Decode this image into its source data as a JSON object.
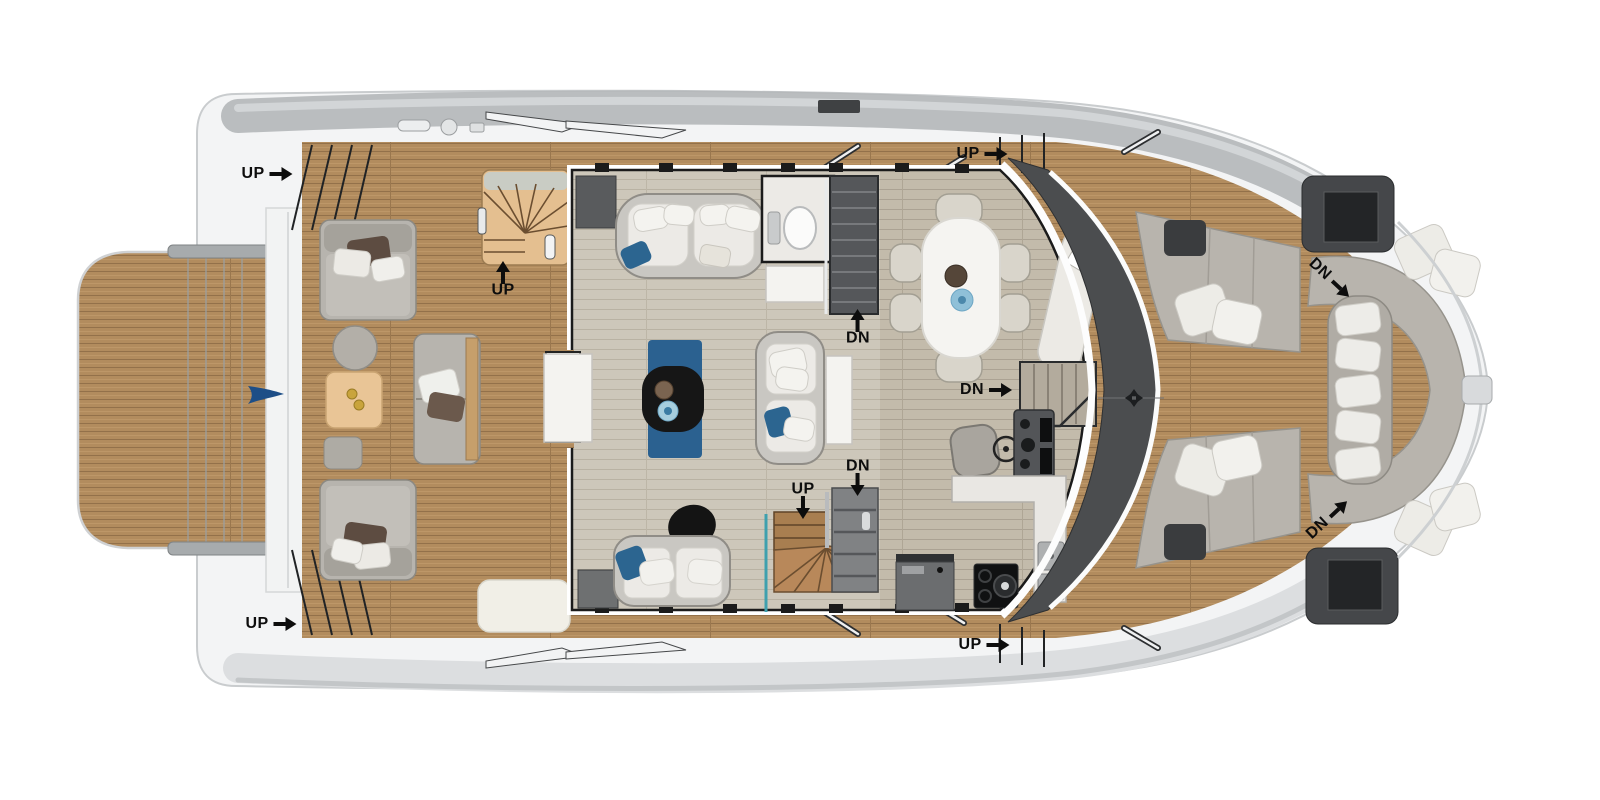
{
  "diagram": {
    "type": "yacht-deck-floor-plan",
    "subject": "power-catamaran main deck, top view, bow to the right",
    "deck_labels": [
      {
        "id": "aft-port-side-steps",
        "text": "UP",
        "arrow": "right"
      },
      {
        "id": "cockpit-flybridge-stairs",
        "text": "UP",
        "arrow": "up"
      },
      {
        "id": "port-side-deck-steps",
        "text": "UP",
        "arrow": "right"
      },
      {
        "id": "port-hull-stairs",
        "text": "DN",
        "arrow": "up"
      },
      {
        "id": "starboard-hull-stairs",
        "text": "DN",
        "arrow": "right"
      },
      {
        "id": "salon-center-stairs-up",
        "text": "UP",
        "arrow": "down"
      },
      {
        "id": "salon-center-stairs-down",
        "text": "DN",
        "arrow": "down"
      },
      {
        "id": "starboard-side-deck-steps",
        "text": "UP",
        "arrow": "right"
      },
      {
        "id": "aft-starboard-side-steps",
        "text": "UP",
        "arrow": "right"
      },
      {
        "id": "foredeck-port-companionway",
        "text": "DN",
        "arrow": "diag-down-right"
      },
      {
        "id": "foredeck-starboard-companionway",
        "text": "DN",
        "arrow": "diag-up-right"
      }
    ],
    "icon_names": [
      "windlass-cross-icon",
      "burgee-flag-icon"
    ]
  },
  "colors": {
    "teak_deck": "#b28c5e",
    "teak_plank_line": "#93714a",
    "interior_floor": "#cdc7ba",
    "galley_floor": "#c3bbab",
    "windshield_band": "#4b4d4f",
    "hull_white": "#f3f4f5",
    "hull_shadow_band": "#b4b7b9",
    "accent_blue": "#2c6590",
    "stair_wood": "#b8885a",
    "upholstery_grey": "#c9c7c2",
    "cushion_white": "#eceae6",
    "label_color": "#0d0d0d"
  }
}
